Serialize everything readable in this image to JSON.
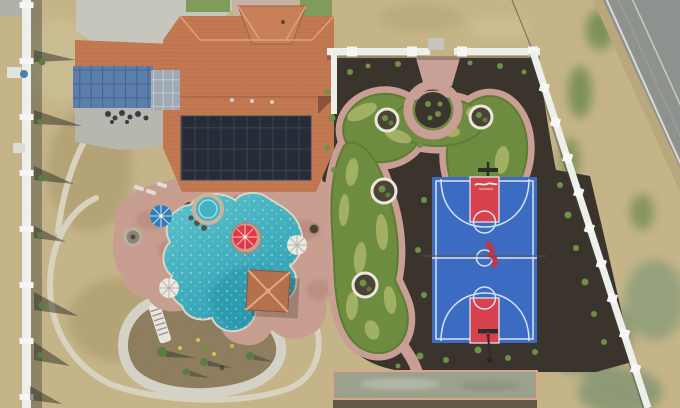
{
  "meta": {
    "kind": "aerial-drone-photo",
    "description": "Overhead aerial photo of a residential estate backyard featuring a freeform pool with spa and lazy-river slide, a synthetic putting green with tree wells, a blue basketball court with red keys, a bocce pad, white vinyl fencing and a rural road at top right",
    "width_px": 680,
    "height_px": 408
  },
  "scene": {
    "ground": {
      "dry_grass_color": "#c5b488",
      "green_patch_color": "#7d9257",
      "dirt_color": "#b3a374"
    },
    "road": {
      "label": "two-lane rural road",
      "asphalt_color": "#8e928e",
      "edge_line_color": "#dcdcd4",
      "shoulder_color": "#b9a87c"
    },
    "fence": {
      "label": "white vinyl property fence",
      "color": "#eef0ec",
      "shadow_color": "rgba(60,60,55,0.4)"
    },
    "house": {
      "label": "house with terracotta tile roof",
      "roof_color": "#c2774f",
      "roof_ridge_color": "#dfa07a",
      "entry_hip_color": "#c87e57",
      "solar_array_color": "#232a36",
      "solar_grid_color": "#39434f",
      "canopy_color": "#5b7dac",
      "skylight_color": "#9fa9b6",
      "driveway_color": "#c6c6be",
      "patio_color": "#b7b7af",
      "lawn_color": "#7f9b59",
      "front_walk_color": "#c8b2a6"
    },
    "pool": {
      "label": "freeform swimming pool",
      "water_light": "#5cc4cd",
      "water_deep": "#2b9db2",
      "deck_color": "#c79e90",
      "coping_color": "#dcd4c4",
      "spa_color": "#3fb3c1",
      "spa_ring_color": "#cbb49e",
      "umbrellas": [
        {
          "name": "blue-umbrella",
          "color": "#2d7cba"
        },
        {
          "name": "red-umbrella",
          "color": "#e23442"
        },
        {
          "name": "white-umbrella-east",
          "color": "#ece9e2"
        },
        {
          "name": "white-umbrella-southwest",
          "color": "#ece9e2"
        }
      ],
      "gazebo_roof_color": "#b5704c",
      "gazebo_ridge_color": "#e2aa7e",
      "lazy_river_channel_color": "#d4d2c6",
      "island_dirt_color": "#8d7d5e",
      "stair_color": "#e8e6de"
    },
    "putting_green": {
      "label": "synthetic putting green",
      "grass_color": "#6d8c3e",
      "light_patch_color": "#a8b468",
      "fringe_color": "#5d7c31",
      "path_color": "#c89e95",
      "entry_pad_color": "#c9a097",
      "mulch_color": "#39322a",
      "tree_well_count": 4,
      "tree_well_ring_color": "#ece8dc",
      "shrub_color": "#6f8f46"
    },
    "basketball_court": {
      "label": "full basketball court",
      "surface_color": "#3a6ac2",
      "key_color": "#d8404c",
      "line_color": "#d8e4f4",
      "hoop_count": 2,
      "hoop_color": "#2a2b28",
      "center_net_color": "#55564f",
      "logo_color": "#c23340"
    },
    "bocce_pad": {
      "label": "concrete game pad",
      "color": "#9ba18c",
      "border_color": "#d9a58f"
    },
    "outer_path_color": "#d8d2bf",
    "shadow_color": "rgba(40,44,36,0.5)"
  }
}
